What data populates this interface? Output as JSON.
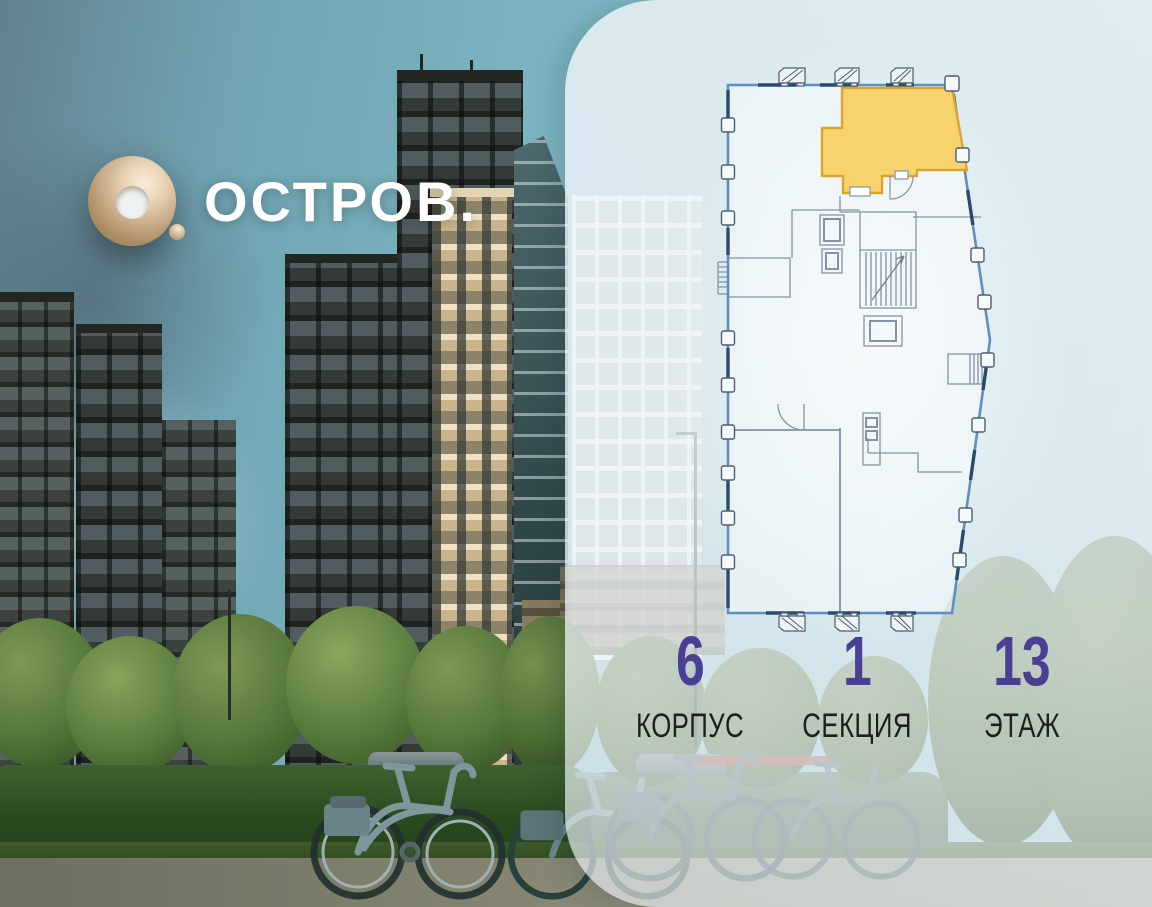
{
  "brand": {
    "title": "ОСТРОВ.",
    "logo_icon": "gold-ring-with-period",
    "logo_gold": "#CDB291",
    "title_color": "#FFFFFF"
  },
  "panel": {
    "floor_plan": {
      "boundary_color": "#5E8FC0",
      "accent_color": "#2B4A6B",
      "interior_color": "#8593A6",
      "selected_unit_fill": "#F8D26C",
      "selected_unit_stroke": "#D8A62F"
    },
    "details": {
      "value_color": "#4A3F92",
      "label_color": "#1F1F1D",
      "items": [
        {
          "value": "6",
          "label": "КОРПУС"
        },
        {
          "value": "1",
          "label": "СЕКЦИЯ"
        },
        {
          "value": "13",
          "label": "ЭТАЖ"
        }
      ]
    }
  }
}
